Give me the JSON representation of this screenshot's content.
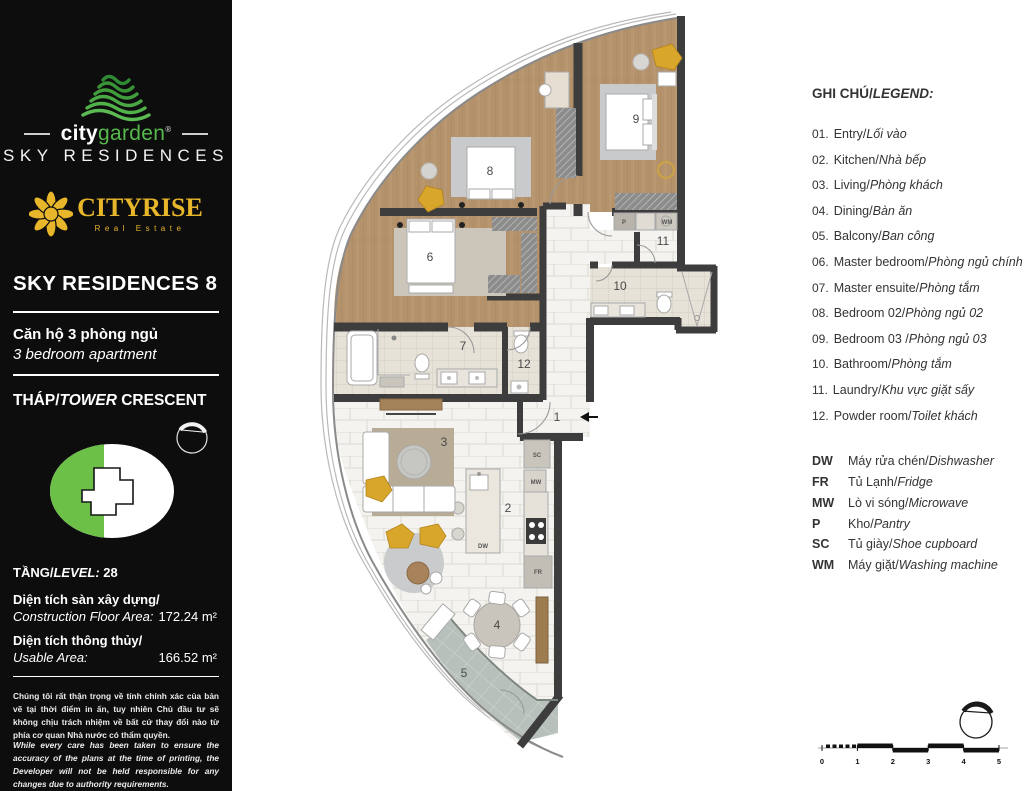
{
  "sidebar": {
    "brand": {
      "city": "city",
      "garden": "garden",
      "reg": "®",
      "sky": "SKY RESIDENCES"
    },
    "cityrise": {
      "name": "CITYRISE",
      "sub": "Real Estate"
    },
    "unit_title": "SKY RESIDENCES 8",
    "unit_type_vi": "Căn hộ 3 phòng ngủ",
    "unit_type_en": "3 bedroom apartment",
    "tower": {
      "vi": "THÁP/",
      "en": "TOWER",
      "name": " CRESCENT"
    },
    "level": {
      "vi": "TẦNG/",
      "en": "LEVEL:",
      "value": " 28"
    },
    "areas": [
      {
        "vi": "Diện tích sàn xây dựng/",
        "en": "Construction Floor Area:",
        "value": "172.24 m²"
      },
      {
        "vi": "Diện tích thông thủy/",
        "en": "Usable Area:",
        "value": "166.52 m²"
      }
    ],
    "disclaimer_vi": "Chúng tôi rất thận trọng về tính chính xác của bản vẽ tại thời điểm in ấn, tuy nhiên Chủ đầu tư sẽ không chịu trách nhiệm về bất cứ thay đổi nào từ phía cơ quan Nhà nước có thẩm quyền.",
    "disclaimer_en": "While every care has been taken to ensure the accuracy of the plans at the time of printing, the Developer will not be held responsible for any changes due to authority requirements."
  },
  "legend": {
    "title_vi": "GHI CHÚ/",
    "title_en": "LEGEND:",
    "items": [
      {
        "num": "01.",
        "en": "Entry/",
        "vi": "Lối vào"
      },
      {
        "num": "02.",
        "en": "Kitchen/",
        "vi": "Nhà bếp"
      },
      {
        "num": "03.",
        "en": "Living/",
        "vi": "Phòng khách"
      },
      {
        "num": "04.",
        "en": "Dining/",
        "vi": "Bàn ăn"
      },
      {
        "num": "05.",
        "en": "Balcony/",
        "vi": "Ban công"
      },
      {
        "num": "06.",
        "en": "Master bedroom/",
        "vi": "Phòng ngủ chính"
      },
      {
        "num": "07.",
        "en": "Master ensuite/",
        "vi": "Phòng tắm"
      },
      {
        "num": "08.",
        "en": "Bedroom 02/",
        "vi": "Phòng ngủ 02"
      },
      {
        "num": "09.",
        "en": "Bedroom 03 /",
        "vi": "Phòng ngủ 03"
      },
      {
        "num": "10.",
        "en": "Bathroom/",
        "vi": "Phòng tắm"
      },
      {
        "num": "11.",
        "en": "Laundry/",
        "vi": "Khu vực giặt sấy"
      },
      {
        "num": "12.",
        "en": "Powder room/",
        "vi": "Toilet khách"
      }
    ],
    "abbr": [
      {
        "code": "DW",
        "vi": "Máy rửa chén/",
        "en": "Dishwasher"
      },
      {
        "code": "FR",
        "vi": "Tủ Lạnh/",
        "en": "Fridge"
      },
      {
        "code": "MW",
        "vi": "Lò vi sóng/",
        "en": "Microwave"
      },
      {
        "code": "P",
        "vi": "Kho/",
        "en": "Pantry"
      },
      {
        "code": "SC",
        "vi": "Tủ giày/",
        "en": "Shoe cupboard"
      },
      {
        "code": "WM",
        "vi": "Máy giặt/",
        "en": "Washing machine"
      }
    ]
  },
  "plan": {
    "rooms": [
      "1",
      "2",
      "3",
      "4",
      "5",
      "6",
      "7",
      "8",
      "9",
      "10",
      "11",
      "12"
    ],
    "tags": {
      "pantry": "P",
      "washing": "WM",
      "microwave": "MW",
      "fridge": "FR",
      "dishwasher": "DW",
      "shoe": "SC"
    }
  },
  "scalebar": {
    "ticks": [
      "0",
      "1",
      "2",
      "3",
      "4",
      "5"
    ]
  },
  "colors": {
    "brand_green": "#56b84c",
    "brand_gold": "#e8b62a",
    "wood": "#b4926b",
    "balcony": "#b7c0ba",
    "wall": "#3d3d3d"
  }
}
